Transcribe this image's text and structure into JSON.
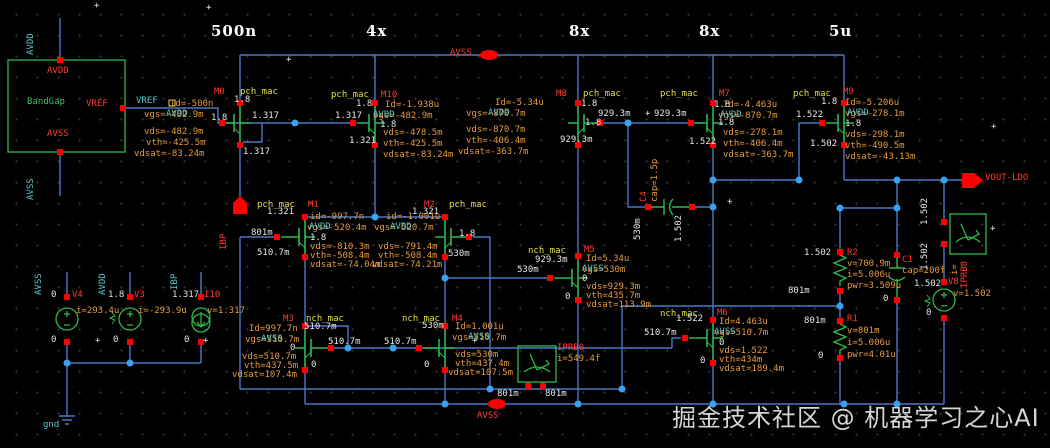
{
  "watermark": {
    "text": "掘金技术社区 @ 机器学习之心AI"
  },
  "colors": {
    "wire": "#4b79c4",
    "device": "#2db84d",
    "pin": "#ff0000",
    "dot": "#3aa0f0",
    "param": "#e89a3c",
    "node": "#e6e6e6",
    "net": "#5cc8c8",
    "instance": "#ff3b30",
    "cell": "#e0e042"
  },
  "labels": [
    {
      "t": "500n",
      "x": 211,
      "y": 22,
      "c": "b"
    },
    {
      "t": "4x",
      "x": 366,
      "y": 22,
      "c": "b"
    },
    {
      "t": "8x",
      "x": 569,
      "y": 22,
      "c": "b"
    },
    {
      "t": "8x",
      "x": 699,
      "y": 22,
      "c": "b"
    },
    {
      "t": "5u",
      "x": 829,
      "y": 22,
      "c": "b"
    },
    {
      "t": "AVDD",
      "x": 36,
      "y": 45,
      "c": "cy",
      "r": 1
    },
    {
      "t": "AVSS",
      "x": 36,
      "y": 190,
      "c": "cy",
      "r": 1
    },
    {
      "t": "AVDD",
      "x": 47,
      "y": 66,
      "c": "r"
    },
    {
      "t": "BandGap",
      "x": 27,
      "y": 97,
      "c": "g",
      "n": "instance-bandgap"
    },
    {
      "t": "VREF",
      "x": 86,
      "y": 99,
      "c": "r"
    },
    {
      "t": "AVSS",
      "x": 47,
      "y": 129,
      "c": "r"
    },
    {
      "t": "VREF",
      "x": 136,
      "y": 96,
      "c": "cy"
    },
    {
      "t": "AVSS",
      "x": 450,
      "y": 48,
      "c": "r",
      "n": "pin-avss-top"
    },
    {
      "t": "AVSS",
      "x": 477,
      "y": 411,
      "c": "r",
      "n": "pin-avss-bottom"
    },
    {
      "t": "VOUT-LDO",
      "x": 985,
      "y": 173,
      "c": "r",
      "n": "pin-vout-ldo"
    },
    {
      "t": "IBP",
      "x": 229,
      "y": 240,
      "c": "r",
      "r": 1,
      "n": "pin-ibp"
    },
    {
      "t": "M0",
      "x": 214,
      "y": 87,
      "c": "r",
      "n": "instance-m0"
    },
    {
      "t": "pch_mac",
      "x": 240,
      "y": 87,
      "c": "y"
    },
    {
      "t": "1.8",
      "x": 234,
      "y": 95,
      "c": "w"
    },
    {
      "t": "Id=-500n",
      "x": 170,
      "y": 99,
      "c": "o"
    },
    {
      "t": "vgs=-482.9m",
      "x": 144,
      "y": 110,
      "c": "o"
    },
    {
      "t": "AVDD",
      "x": 166,
      "y": 109,
      "c": "cy"
    },
    {
      "t": "1.8",
      "x": 211,
      "y": 113,
      "c": "w"
    },
    {
      "t": "1.317",
      "x": 252,
      "y": 111,
      "c": "w"
    },
    {
      "t": "vds=-482.9m",
      "x": 144,
      "y": 127,
      "c": "o"
    },
    {
      "t": "vth=-425.5m",
      "x": 146,
      "y": 138,
      "c": "o"
    },
    {
      "t": "vdsat=-83.24m",
      "x": 134,
      "y": 149,
      "c": "o"
    },
    {
      "t": "1.317",
      "x": 243,
      "y": 147,
      "c": "w"
    },
    {
      "t": "pch_mac",
      "x": 331,
      "y": 90,
      "c": "y"
    },
    {
      "t": "M10",
      "x": 381,
      "y": 90,
      "c": "r",
      "n": "instance-m10"
    },
    {
      "t": "1.8",
      "x": 356,
      "y": 99,
      "c": "w"
    },
    {
      "t": "1.317",
      "x": 335,
      "y": 111,
      "c": "w"
    },
    {
      "t": "1.8",
      "x": 380,
      "y": 120,
      "c": "w"
    },
    {
      "t": "1.321",
      "x": 349,
      "y": 136,
      "c": "w"
    },
    {
      "t": "Id=-1.938u",
      "x": 385,
      "y": 100,
      "c": "o"
    },
    {
      "t": "vgs=-482.9m",
      "x": 373,
      "y": 111,
      "c": "o"
    },
    {
      "t": "AVDD",
      "x": 373,
      "y": 110,
      "c": "cy"
    },
    {
      "t": "vds=-478.5m",
      "x": 383,
      "y": 128,
      "c": "o"
    },
    {
      "t": "vth=-425.5m",
      "x": 383,
      "y": 139,
      "c": "o"
    },
    {
      "t": "vdsat=-83.24m",
      "x": 383,
      "y": 150,
      "c": "o"
    },
    {
      "t": "M8",
      "x": 556,
      "y": 89,
      "c": "r",
      "n": "instance-m8"
    },
    {
      "t": "pch_mac",
      "x": 583,
      "y": 89,
      "c": "y"
    },
    {
      "t": "1.8",
      "x": 581,
      "y": 99,
      "c": "w"
    },
    {
      "t": "929.3m",
      "x": 598,
      "y": 109,
      "c": "w"
    },
    {
      "t": "+",
      "x": 645,
      "y": 109,
      "c": "w"
    },
    {
      "t": "929.3m",
      "x": 654,
      "y": 109,
      "c": "w"
    },
    {
      "t": "1.8",
      "x": 585,
      "y": 118,
      "c": "w"
    },
    {
      "t": "929.3m",
      "x": 560,
      "y": 135,
      "c": "w"
    },
    {
      "t": "Id=-5.34u",
      "x": 495,
      "y": 98,
      "c": "o"
    },
    {
      "t": "vgs=-870.7m",
      "x": 466,
      "y": 109,
      "c": "o"
    },
    {
      "t": "AVDD",
      "x": 488,
      "y": 108,
      "c": "cy"
    },
    {
      "t": "vds=-870.7m",
      "x": 466,
      "y": 125,
      "c": "o"
    },
    {
      "t": "vth=-406.4m",
      "x": 466,
      "y": 136,
      "c": "o"
    },
    {
      "t": "vdsat=-363.7m",
      "x": 458,
      "y": 147,
      "c": "o"
    },
    {
      "t": "pch_mac",
      "x": 660,
      "y": 89,
      "c": "y"
    },
    {
      "t": "M7",
      "x": 719,
      "y": 89,
      "c": "r",
      "n": "instance-m7"
    },
    {
      "t": "1.8",
      "x": 714,
      "y": 100,
      "c": "w"
    },
    {
      "t": "1.8",
      "x": 718,
      "y": 118,
      "c": "w"
    },
    {
      "t": "1.522",
      "x": 689,
      "y": 137,
      "c": "w"
    },
    {
      "t": "Id=-4.463u",
      "x": 723,
      "y": 100,
      "c": "o"
    },
    {
      "t": "vgs=-870.7m",
      "x": 718,
      "y": 111,
      "c": "o"
    },
    {
      "t": "AVDD",
      "x": 720,
      "y": 110,
      "c": "cy"
    },
    {
      "t": "vds=-278.1m",
      "x": 723,
      "y": 128,
      "c": "o"
    },
    {
      "t": "vth=-406.4m",
      "x": 723,
      "y": 139,
      "c": "o"
    },
    {
      "t": "vdsat=-363.7m",
      "x": 723,
      "y": 150,
      "c": "o"
    },
    {
      "t": "pch_mac",
      "x": 793,
      "y": 89,
      "c": "y"
    },
    {
      "t": "M9",
      "x": 843,
      "y": 87,
      "c": "r",
      "n": "instance-m9"
    },
    {
      "t": "1.8",
      "x": 821,
      "y": 97,
      "c": "w"
    },
    {
      "t": "1.522",
      "x": 796,
      "y": 110,
      "c": "w"
    },
    {
      "t": "1.8",
      "x": 845,
      "y": 119,
      "c": "w"
    },
    {
      "t": "1.502",
      "x": 810,
      "y": 139,
      "c": "w"
    },
    {
      "t": "Id=-5.206u",
      "x": 845,
      "y": 98,
      "c": "o"
    },
    {
      "t": "vgs=-278.1m",
      "x": 845,
      "y": 109,
      "c": "o"
    },
    {
      "t": "AVDD",
      "x": 847,
      "y": 108,
      "c": "cy"
    },
    {
      "t": "vds=-298.1m",
      "x": 845,
      "y": 130,
      "c": "o"
    },
    {
      "t": "vth=-490.5m",
      "x": 845,
      "y": 141,
      "c": "o"
    },
    {
      "t": "vdsat=-43.13m",
      "x": 845,
      "y": 152,
      "c": "o"
    },
    {
      "t": "pch_mac",
      "x": 257,
      "y": 200,
      "c": "y"
    },
    {
      "t": "M1",
      "x": 308,
      "y": 200,
      "c": "r",
      "n": "instance-m1"
    },
    {
      "t": "1.321",
      "x": 267,
      "y": 207,
      "c": "w"
    },
    {
      "t": "801m",
      "x": 251,
      "y": 228,
      "c": "w"
    },
    {
      "t": "510.7m",
      "x": 257,
      "y": 248,
      "c": "w"
    },
    {
      "t": "id=-997.7n",
      "x": 310,
      "y": 212,
      "c": "o"
    },
    {
      "t": "vgs=-520.4m",
      "x": 307,
      "y": 223,
      "c": "o"
    },
    {
      "t": "AVDD",
      "x": 309,
      "y": 222,
      "c": "cy"
    },
    {
      "t": "1.8",
      "x": 310,
      "y": 233,
      "c": "w"
    },
    {
      "t": "vds=-810.3m",
      "x": 310,
      "y": 242,
      "c": "o"
    },
    {
      "t": "vth=-508.4m",
      "x": 310,
      "y": 251,
      "c": "o"
    },
    {
      "t": "vdsat=-74.04m",
      "x": 310,
      "y": 260,
      "c": "o"
    },
    {
      "t": "M2",
      "x": 424,
      "y": 200,
      "c": "r",
      "n": "instance-m2"
    },
    {
      "t": "pch_mac",
      "x": 449,
      "y": 200,
      "c": "y"
    },
    {
      "t": "1.321",
      "x": 412,
      "y": 207,
      "c": "w"
    },
    {
      "t": "id=-1.001u",
      "x": 386,
      "y": 212,
      "c": "o"
    },
    {
      "t": "vgs=-520.7m",
      "x": 374,
      "y": 223,
      "c": "o"
    },
    {
      "t": "AVDD",
      "x": 390,
      "y": 222,
      "c": "cy"
    },
    {
      "t": "1.8",
      "x": 459,
      "y": 229,
      "c": "w"
    },
    {
      "t": "vds=-791.4m",
      "x": 378,
      "y": 242,
      "c": "o"
    },
    {
      "t": "vth=-508.4m",
      "x": 378,
      "y": 251,
      "c": "o"
    },
    {
      "t": "vdsat=-74.21m",
      "x": 372,
      "y": 260,
      "c": "o"
    },
    {
      "t": "530m",
      "x": 448,
      "y": 249,
      "c": "w"
    },
    {
      "t": "M3",
      "x": 283,
      "y": 314,
      "c": "r",
      "n": "instance-m3"
    },
    {
      "t": "nch_mac",
      "x": 306,
      "y": 314,
      "c": "y"
    },
    {
      "t": "510.7m",
      "x": 304,
      "y": 322,
      "c": "w"
    },
    {
      "t": "510.7m",
      "x": 328,
      "y": 337,
      "c": "w"
    },
    {
      "t": "0",
      "x": 290,
      "y": 343,
      "c": "w"
    },
    {
      "t": "0",
      "x": 311,
      "y": 360,
      "c": "w"
    },
    {
      "t": "Id=997.7n",
      "x": 249,
      "y": 324,
      "c": "o"
    },
    {
      "t": "vgs=510.7m",
      "x": 245,
      "y": 335,
      "c": "o"
    },
    {
      "t": "AVSS",
      "x": 261,
      "y": 334,
      "c": "cy"
    },
    {
      "t": "vds=510.7m",
      "x": 242,
      "y": 352,
      "c": "o"
    },
    {
      "t": "vth=437.5m",
      "x": 244,
      "y": 361,
      "c": "o"
    },
    {
      "t": "vdsat=107.4m",
      "x": 232,
      "y": 370,
      "c": "o"
    },
    {
      "t": "nch_mac",
      "x": 402,
      "y": 314,
      "c": "y"
    },
    {
      "t": "530m",
      "x": 422,
      "y": 321,
      "c": "w"
    },
    {
      "t": "M4",
      "x": 452,
      "y": 314,
      "c": "r",
      "n": "instance-m4"
    },
    {
      "t": "510.7m",
      "x": 384,
      "y": 337,
      "c": "w"
    },
    {
      "t": "0",
      "x": 424,
      "y": 360,
      "c": "w"
    },
    {
      "t": "Id=1.001u",
      "x": 455,
      "y": 322,
      "c": "o"
    },
    {
      "t": "vgs=510.7m",
      "x": 452,
      "y": 333,
      "c": "o"
    },
    {
      "t": "AVSS",
      "x": 468,
      "y": 332,
      "c": "cy"
    },
    {
      "t": "vds=530m",
      "x": 455,
      "y": 350,
      "c": "o"
    },
    {
      "t": "vth=437.4m",
      "x": 455,
      "y": 359,
      "c": "o"
    },
    {
      "t": "vdsat=107.5m",
      "x": 448,
      "y": 368,
      "c": "o"
    },
    {
      "t": "nch_mac",
      "x": 528,
      "y": 246,
      "c": "y"
    },
    {
      "t": "M5",
      "x": 584,
      "y": 245,
      "c": "r",
      "n": "instance-m5"
    },
    {
      "t": "929.3m",
      "x": 535,
      "y": 255,
      "c": "w"
    },
    {
      "t": "530m",
      "x": 517,
      "y": 265,
      "c": "w"
    },
    {
      "t": "Id=5.34u",
      "x": 586,
      "y": 254,
      "c": "o"
    },
    {
      "t": "vgs=530m",
      "x": 582,
      "y": 265,
      "c": "o"
    },
    {
      "t": "AVSS",
      "x": 582,
      "y": 264,
      "c": "cy"
    },
    {
      "t": "0",
      "x": 582,
      "y": 274,
      "c": "w"
    },
    {
      "t": "vds=929.3m",
      "x": 586,
      "y": 282,
      "c": "o"
    },
    {
      "t": "vth=435.7m",
      "x": 586,
      "y": 291,
      "c": "o"
    },
    {
      "t": "vdsat=113.9m",
      "x": 586,
      "y": 300,
      "c": "o"
    },
    {
      "t": "0",
      "x": 565,
      "y": 292,
      "c": "w"
    },
    {
      "t": "nch_mac",
      "x": 660,
      "y": 309,
      "c": "y"
    },
    {
      "t": "M6",
      "x": 717,
      "y": 308,
      "c": "r",
      "n": "instance-m6"
    },
    {
      "t": "1.522",
      "x": 676,
      "y": 314,
      "c": "w"
    },
    {
      "t": "510.7m",
      "x": 644,
      "y": 328,
      "c": "w"
    },
    {
      "t": "Id=4.463u",
      "x": 719,
      "y": 317,
      "c": "o"
    },
    {
      "t": "vgs=510.7m",
      "x": 714,
      "y": 328,
      "c": "o"
    },
    {
      "t": "AVSS",
      "x": 714,
      "y": 327,
      "c": "cy"
    },
    {
      "t": "0",
      "x": 719,
      "y": 338,
      "c": "w"
    },
    {
      "t": "vds=1.522",
      "x": 719,
      "y": 346,
      "c": "o"
    },
    {
      "t": "vth=434m",
      "x": 719,
      "y": 355,
      "c": "o"
    },
    {
      "t": "vdsat=189.4m",
      "x": 719,
      "y": 364,
      "c": "o"
    },
    {
      "t": "0",
      "x": 700,
      "y": 356,
      "c": "w"
    },
    {
      "t": "IPRB0",
      "x": 557,
      "y": 343,
      "c": "r",
      "n": "instance-iprb0"
    },
    {
      "t": "i=549.4f",
      "x": 557,
      "y": 354,
      "c": "o"
    },
    {
      "t": "801m",
      "x": 497,
      "y": 389,
      "c": "w"
    },
    {
      "t": "801m",
      "x": 545,
      "y": 389,
      "c": "w"
    },
    {
      "t": "C4",
      "x": 649,
      "y": 192,
      "c": "r",
      "r": 1,
      "n": "instance-c4"
    },
    {
      "t": "cap=1.5p",
      "x": 660,
      "y": 192,
      "c": "o",
      "r": 1
    },
    {
      "t": "530m",
      "x": 643,
      "y": 230,
      "c": "w",
      "r": 1
    },
    {
      "t": "1.502",
      "x": 684,
      "y": 232,
      "c": "w",
      "r": 1
    },
    {
      "t": "R2",
      "x": 847,
      "y": 248,
      "c": "r",
      "n": "instance-r2"
    },
    {
      "t": "v=700.9m",
      "x": 847,
      "y": 259,
      "c": "o"
    },
    {
      "t": "i=5.006u",
      "x": 847,
      "y": 270,
      "c": "o"
    },
    {
      "t": "pwr=3.509u",
      "x": 847,
      "y": 281,
      "c": "o"
    },
    {
      "t": "1.502",
      "x": 804,
      "y": 248,
      "c": "w"
    },
    {
      "t": "801m",
      "x": 788,
      "y": 286,
      "c": "w"
    },
    {
      "t": "R1",
      "x": 847,
      "y": 314,
      "c": "r",
      "n": "instance-r1"
    },
    {
      "t": "v=801m",
      "x": 847,
      "y": 326,
      "c": "o"
    },
    {
      "t": "i=5.006u",
      "x": 847,
      "y": 338,
      "c": "o"
    },
    {
      "t": "pwr=4.01u",
      "x": 847,
      "y": 350,
      "c": "o"
    },
    {
      "t": "801m",
      "x": 804,
      "y": 316,
      "c": "w"
    },
    {
      "t": "0",
      "x": 818,
      "y": 351,
      "c": "w"
    },
    {
      "t": "C1",
      "x": 902,
      "y": 255,
      "c": "r",
      "n": "instance-c1"
    },
    {
      "t": "cap=200f",
      "x": 902,
      "y": 266,
      "c": "o"
    },
    {
      "t": "0",
      "x": 883,
      "y": 294,
      "c": "w"
    },
    {
      "t": "1.502",
      "x": 930,
      "y": 215,
      "c": "w",
      "r": 1
    },
    {
      "t": "1.502",
      "x": 930,
      "y": 260,
      "c": "w",
      "r": 1
    },
    {
      "t": "IPRB8",
      "x": 970,
      "y": 278,
      "c": "r",
      "r": 1,
      "n": "instance-iprb8"
    },
    {
      "t": "i=",
      "x": 960,
      "y": 265,
      "c": "o",
      "r": 1
    },
    {
      "t": "1.502",
      "x": 914,
      "y": 279,
      "c": "w"
    },
    {
      "t": "V8",
      "x": 948,
      "y": 277,
      "c": "r",
      "n": "instance-v8"
    },
    {
      "t": "v=1.502",
      "x": 953,
      "y": 289,
      "c": "o"
    },
    {
      "t": "0",
      "x": 926,
      "y": 308,
      "c": "w"
    },
    {
      "t": "AVSS",
      "x": 44,
      "y": 285,
      "c": "cy",
      "r": 1
    },
    {
      "t": "AVDD",
      "x": 108,
      "y": 285,
      "c": "cy",
      "r": 1
    },
    {
      "t": "IBP",
      "x": 180,
      "y": 280,
      "c": "cy",
      "r": 1
    },
    {
      "t": "0",
      "x": 51,
      "y": 290,
      "c": "w"
    },
    {
      "t": "V4",
      "x": 72,
      "y": 290,
      "c": "r",
      "n": "instance-v4"
    },
    {
      "t": "i=293.4u",
      "x": 76,
      "y": 306,
      "c": "o"
    },
    {
      "t": "0",
      "x": 51,
      "y": 335,
      "c": "w"
    },
    {
      "t": "1.8",
      "x": 108,
      "y": 290,
      "c": "w"
    },
    {
      "t": "V3",
      "x": 134,
      "y": 290,
      "c": "r",
      "n": "instance-v3"
    },
    {
      "t": "i=-293.9u",
      "x": 138,
      "y": 306,
      "c": "o"
    },
    {
      "t": "0",
      "x": 113,
      "y": 335,
      "c": "w"
    },
    {
      "t": "1.317",
      "x": 172,
      "y": 290,
      "c": "w"
    },
    {
      "t": "I10",
      "x": 204,
      "y": 290,
      "c": "r",
      "n": "instance-i10"
    },
    {
      "t": "v=1.317",
      "x": 207,
      "y": 306,
      "c": "o"
    },
    {
      "t": "0",
      "x": 184,
      "y": 335,
      "c": "w"
    },
    {
      "t": "gnd",
      "x": 43,
      "y": 420,
      "c": "cy"
    },
    {
      "t": "+",
      "x": 94,
      "y": 1,
      "c": "w"
    },
    {
      "t": "+",
      "x": 206,
      "y": 3,
      "c": "w"
    },
    {
      "t": "+",
      "x": 286,
      "y": 55,
      "c": "w"
    },
    {
      "t": "+",
      "x": 991,
      "y": 122,
      "c": "w"
    },
    {
      "t": "+",
      "x": 990,
      "y": 224,
      "c": "w"
    },
    {
      "t": "+",
      "x": 727,
      "y": 197,
      "c": "w"
    },
    {
      "t": "+",
      "x": 472,
      "y": 336,
      "c": "w"
    },
    {
      "t": "+",
      "x": 203,
      "y": 336,
      "c": "w"
    },
    {
      "t": "+",
      "x": 95,
      "y": 336,
      "c": "w"
    }
  ]
}
